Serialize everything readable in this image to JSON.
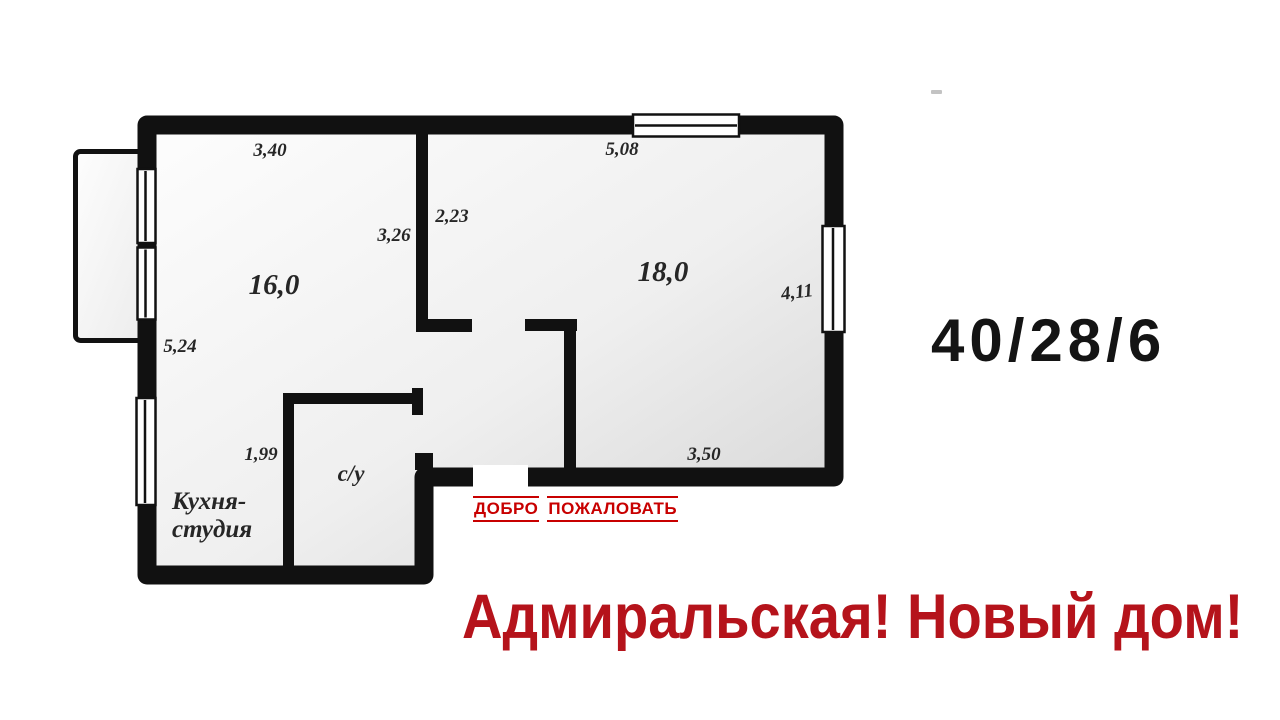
{
  "colors": {
    "wall": "#111111",
    "dimension_text": "#262626",
    "welcome_red": "#c80000",
    "tagline_red": "#b5131b",
    "ratio_black": "#141414",
    "floor_light": "#fdfdfd",
    "floor_dark": "#d4d4d4"
  },
  "floor_plan": {
    "labels": {
      "dim_room1_top": "3,40",
      "dim_room2_top": "5,08",
      "dim_hall_width": "2,23",
      "dim_room1_wall": "3,26",
      "area_room1": "16,0",
      "area_room2": "18,0",
      "dim_right_wall": "4,11",
      "dim_left_wall": "5,24",
      "dim_kitchen_width": "1,99",
      "dim_room2_bottom": "3,50",
      "room_bathroom": "с/у",
      "room_kitchen_line1": "Кухня-",
      "room_kitchen_line2": "студия"
    }
  },
  "marketing": {
    "welcome_word1": "ДОБРО",
    "welcome_word2": "ПОЖАЛОВАТЬ",
    "spec_ratio": "40/28/6",
    "tagline": "Адмиральская! Новый дом!"
  }
}
